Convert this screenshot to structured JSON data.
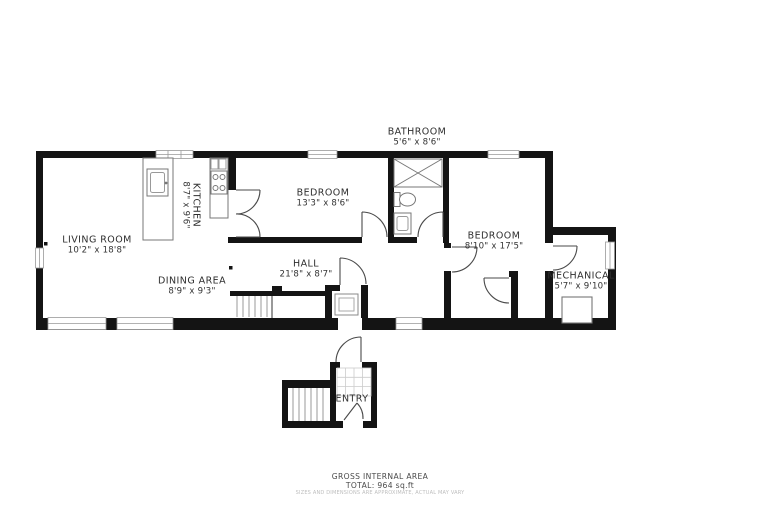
{
  "rooms": [
    {
      "name": "BATHROOM",
      "dims": "5'6\" x 8'6\""
    },
    {
      "name": "LIVING ROOM",
      "dims": "10'2\" x 18'8\""
    },
    {
      "name": "KITCHEN",
      "dims": "8'7\" x 9'6\""
    },
    {
      "name": "DINING AREA",
      "dims": "8'9\" x 9'3\""
    },
    {
      "name": "BEDROOM",
      "dims": "13'3\" x 8'6\""
    },
    {
      "name": "HALL",
      "dims": "21'8\" x 8'7\""
    },
    {
      "name": "BEDROOM",
      "dims": "8'10\" x 17'5\""
    },
    {
      "name": "MECHANICAL",
      "dims": "5'7\" x 9'10\""
    },
    {
      "name": "ENTRY",
      "dims": ""
    }
  ],
  "footer": {
    "area_title": "GROSS INTERNAL AREA",
    "area_total": "TOTAL: 964 sq.ft",
    "disclaimer": "SIZES AND DIMENSIONS ARE APPROXIMATE, ACTUAL MAY VARY"
  },
  "colors": {
    "wall": "#141414",
    "fixture_stroke": "#777777",
    "window_stroke": "#999999",
    "background": "#ffffff"
  }
}
